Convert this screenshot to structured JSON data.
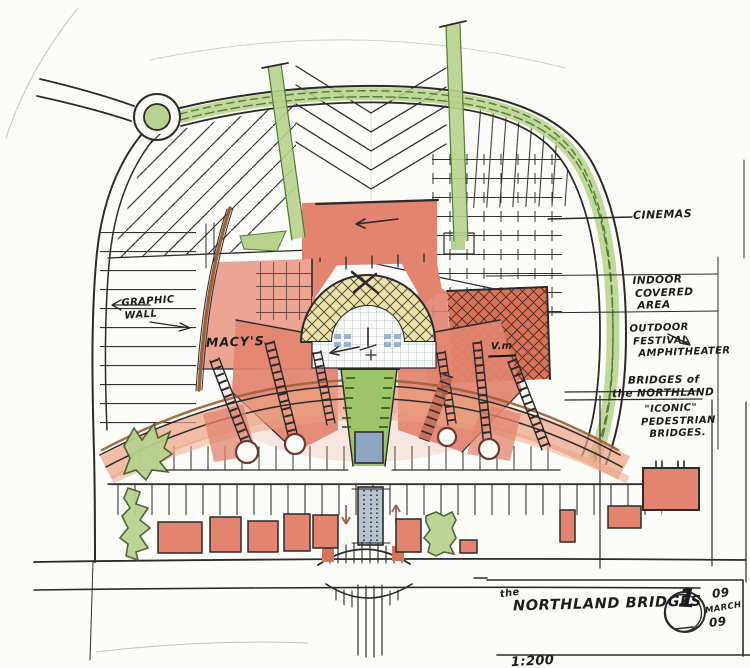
{
  "drawing": {
    "title_prefix": "the",
    "title": "NORTHLAND BRIDGES",
    "sheet_number": "1",
    "date_day": "09",
    "date_month": "MARCH",
    "date_year": "09",
    "scale": "1:200"
  },
  "labels": {
    "cinemas": "CINEMAS",
    "indoor_covered_area": {
      "l1": "INDOOR",
      "l2": "COVERED",
      "l3": "AREA"
    },
    "outdoor_festival_amphitheater": {
      "l1": "OUTDOOR",
      "l2": "FESTIVAL",
      "l3": "AMPHITHEATER"
    },
    "bridges_of_the_northland": {
      "l1": "BRIDGES of",
      "l2": "the NORTHLAND"
    },
    "iconic_pedestrian_bridges": {
      "l1": "\"ICONIC\"",
      "l2": "PEDESTRIAN",
      "l3": "BRIDGES."
    },
    "graphic_wall": {
      "l1": "GRAPHIC",
      "l2": "WALL"
    },
    "macys": "MACY'S",
    "vm": "V.m"
  },
  "colors": {
    "ink": "#2b2b2b",
    "building_red": "#e28470",
    "building_red_dark": "#d8735a",
    "building_red_light": "#eca593",
    "landscape_green": "#b7d28c",
    "lawn_green": "#9cc468",
    "dark_green": "#567b38",
    "water_blue": "#8ea6c2",
    "amphitheater_cream": "#ece2a8",
    "promenade_salmon": "#eba183",
    "wall_brown": "#9a6038"
  }
}
